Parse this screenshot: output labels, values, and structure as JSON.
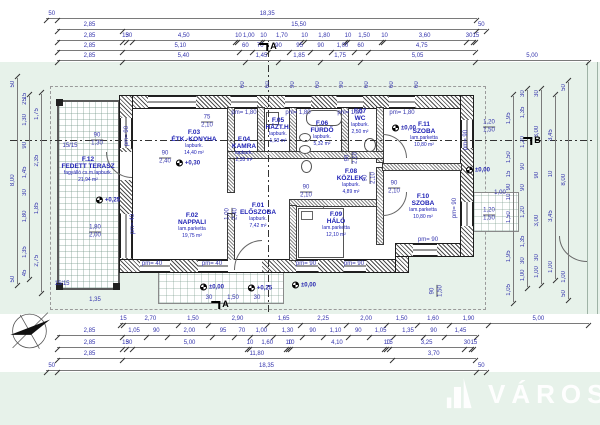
{
  "logo": {
    "name": "VÁROSI"
  },
  "colors": {
    "site_green": "#e7f2ea",
    "dim_blue": "#3434ad",
    "room_blue": "#1f22b5",
    "wall_dark": "#1d1d1d"
  },
  "rooms": [
    {
      "id": "F.01",
      "name": "ELŐSZOBA",
      "floor": "lapburk.",
      "area": "7,42 m²",
      "x": 258,
      "y": 216
    },
    {
      "id": "F.02",
      "name": "NAPPALI",
      "floor": "lam.parketta",
      "area": "19,75 m²",
      "x": 192,
      "y": 226
    },
    {
      "id": "F.03",
      "name": "ÉTK.-KONYHA",
      "floor": "lapburk.",
      "area": "14,40 m²",
      "x": 194,
      "y": 143
    },
    {
      "id": "F.04",
      "name": "KAMRA",
      "floor": "lapburk.",
      "area": "2,35 m²",
      "x": 244,
      "y": 150
    },
    {
      "id": "F.05",
      "name": "HÁZT.H.",
      "floor": "lapburk.",
      "area": "1,03 m²",
      "x": 278,
      "y": 131
    },
    {
      "id": "F.06",
      "name": "FÜRDŐ",
      "floor": "lapburk.",
      "area": "5,32 m²",
      "x": 322,
      "y": 134
    },
    {
      "id": "F.07",
      "name": "WC",
      "floor": "lapburk.",
      "area": "2,50 m²",
      "x": 360,
      "y": 122
    },
    {
      "id": "F.08",
      "name": "KÖZLEK.",
      "floor": "lapburk.",
      "area": "4,89 m²",
      "x": 351,
      "y": 182
    },
    {
      "id": "F.09",
      "name": "HÁLÓ",
      "floor": "lam.parketta",
      "area": "12,10 m²",
      "x": 336,
      "y": 225
    },
    {
      "id": "F.10",
      "name": "SZOBA",
      "floor": "lam.parketta",
      "area": "10,80 m²",
      "x": 423,
      "y": 207
    },
    {
      "id": "F.11",
      "name": "SZOBA",
      "floor": "lam.parketta",
      "area": "10,80 m²",
      "x": 424,
      "y": 135
    },
    {
      "id": "F.12",
      "name": "FEDETT TERASZ",
      "floor": "fagyálló cs.m.lapburk.",
      "area": "21,94 m²",
      "x": 88,
      "y": 170
    }
  ],
  "dims": {
    "t1": [
      "50",
      "18,35"
    ],
    "t2": [
      "2,85",
      "15,50",
      "50"
    ],
    "t3": [
      "2,85",
      "15",
      "30",
      "4,50",
      "10",
      "1,00",
      "10",
      "1,70",
      "10",
      "1,80",
      "10",
      "1,50",
      "10",
      "3,60",
      "30",
      "15"
    ],
    "t4": [
      "2,85",
      "5,10",
      "60",
      "70",
      "90",
      "95",
      "90",
      "1,00",
      "60",
      "4,75"
    ],
    "t5": [
      "2,85",
      "5,40",
      "1,45",
      "1,85",
      "1,75",
      "5,05",
      "5,00"
    ],
    "topv": [
      "60",
      "60",
      "90",
      "60",
      "90",
      "60",
      "60",
      "60"
    ],
    "b1": [
      "15",
      "2,70",
      "1,50",
      "2,90",
      "1,65",
      "2,25",
      "2,00",
      "1,50",
      "1,60",
      "1,90",
      "5,00"
    ],
    "b2": [
      "2,85",
      "1,05",
      "90",
      "2,00",
      "95",
      "70",
      "1,00",
      "1,30",
      "90",
      "1,10",
      "90",
      "1,05",
      "1,35",
      "90",
      "1,45"
    ],
    "b3": [
      "2,85",
      "15",
      "30",
      "5,00",
      "10",
      "1,60",
      "10",
      "10",
      "4,10",
      "10",
      "15",
      "3,25",
      "30",
      "15"
    ],
    "b4": [
      "2,85",
      "11,80",
      "3,70"
    ],
    "b5": [
      "50",
      "18,35",
      "50"
    ],
    "l1": [
      "50",
      "8,00",
      "50"
    ],
    "l2": [
      "15",
      "25",
      "1,30",
      "90",
      "1,45",
      "30",
      "1,80",
      "1,35",
      "45"
    ],
    "l3": [
      "1,75",
      "2,35",
      "1,85",
      "2,75"
    ],
    "r1": [
      "1,95",
      "1,50",
      "15",
      "90",
      "10",
      "1,50",
      "1,95",
      "1,05"
    ],
    "r2": [
      "30",
      "1,35",
      "1,20",
      "90",
      "90",
      "1,20",
      "1,35",
      "30",
      "1,00"
    ],
    "r3": [
      "30",
      "3,00",
      "90",
      "3,00",
      "30",
      "1,00"
    ],
    "r4": [
      "3,45",
      "10",
      "3,45",
      "1,00"
    ],
    "r5": [
      "50",
      "8,00",
      "1,00",
      "50"
    ]
  },
  "pm_labels": [
    {
      "v": "pm= 90",
      "x": 127,
      "y": 136,
      "vert": 1
    },
    {
      "v": "pm= 1,80",
      "x": 244,
      "y": 113
    },
    {
      "v": "pm= 1,80",
      "x": 298,
      "y": 113
    },
    {
      "v": "pm= 1,80",
      "x": 350,
      "y": 113
    },
    {
      "v": "pm= 1,80",
      "x": 402,
      "y": 113
    },
    {
      "v": "pm= 90",
      "x": 466,
      "y": 140,
      "vert": 1
    },
    {
      "v": "pm= 90",
      "x": 455,
      "y": 208,
      "vert": 1
    },
    {
      "v": "pm= 40",
      "x": 133,
      "y": 224,
      "vert": 1
    },
    {
      "v": "pm= 40",
      "x": 152,
      "y": 264
    },
    {
      "v": "pm= 40",
      "x": 212,
      "y": 264
    },
    {
      "v": "pm= 90",
      "x": 306,
      "y": 264
    },
    {
      "v": "pm= 90",
      "x": 354,
      "y": 264
    },
    {
      "v": "pm= 90",
      "x": 428,
      "y": 240
    },
    {
      "v": "15/15",
      "x": 70,
      "y": 146
    },
    {
      "v": "15/15",
      "x": 62,
      "y": 284
    },
    {
      "v": "1,00",
      "x": 500,
      "y": 193
    },
    {
      "v": "30",
      "x": 209,
      "y": 298
    },
    {
      "v": "1,50",
      "x": 233,
      "y": 298
    },
    {
      "v": "30",
      "x": 257,
      "y": 298
    },
    {
      "v": "1,35",
      "x": 95,
      "y": 300
    }
  ],
  "door_labels": [
    {
      "t": "75",
      "b": "2,10",
      "x": 207,
      "y": 122
    },
    {
      "t": "90",
      "b": "2,40",
      "x": 165,
      "y": 158
    },
    {
      "t": "90",
      "b": "1,30",
      "x": 97,
      "y": 140
    },
    {
      "t": "1,80",
      "b": "2,00",
      "x": 95,
      "y": 232
    },
    {
      "t": "90",
      "b": "2,10",
      "x": 306,
      "y": 192
    },
    {
      "t": "90",
      "b": "2,10",
      "x": 352,
      "y": 158,
      "vert": 1
    },
    {
      "t": "90",
      "b": "2,10",
      "x": 370,
      "y": 178,
      "vert": 1
    },
    {
      "t": "90",
      "b": "2,10",
      "x": 394,
      "y": 188
    },
    {
      "t": "1,00",
      "b": "2,40",
      "x": 232,
      "y": 214,
      "vert": 1
    },
    {
      "t": "1,20",
      "b": "1,50",
      "x": 489,
      "y": 127
    },
    {
      "t": "1,20",
      "b": "1,50",
      "x": 489,
      "y": 215
    },
    {
      "t": "90",
      "b": "1,50",
      "x": 437,
      "y": 291,
      "vert": 1
    }
  ],
  "levels": [
    {
      "v": "+0,30",
      "x": 188,
      "y": 163
    },
    {
      "v": "+0,25",
      "x": 108,
      "y": 200
    },
    {
      "v": "±0,00",
      "x": 404,
      "y": 128
    },
    {
      "v": "±0,00",
      "x": 212,
      "y": 287
    },
    {
      "v": "+0,25",
      "x": 260,
      "y": 288
    },
    {
      "v": "±0,00",
      "x": 304,
      "y": 285
    },
    {
      "v": "±0,00",
      "x": 478,
      "y": 170
    }
  ],
  "markers": [
    {
      "l": "A",
      "x": 268,
      "y": 46
    },
    {
      "l": "A",
      "x": 220,
      "y": 304
    },
    {
      "l": "B",
      "x": 532,
      "y": 140
    }
  ]
}
